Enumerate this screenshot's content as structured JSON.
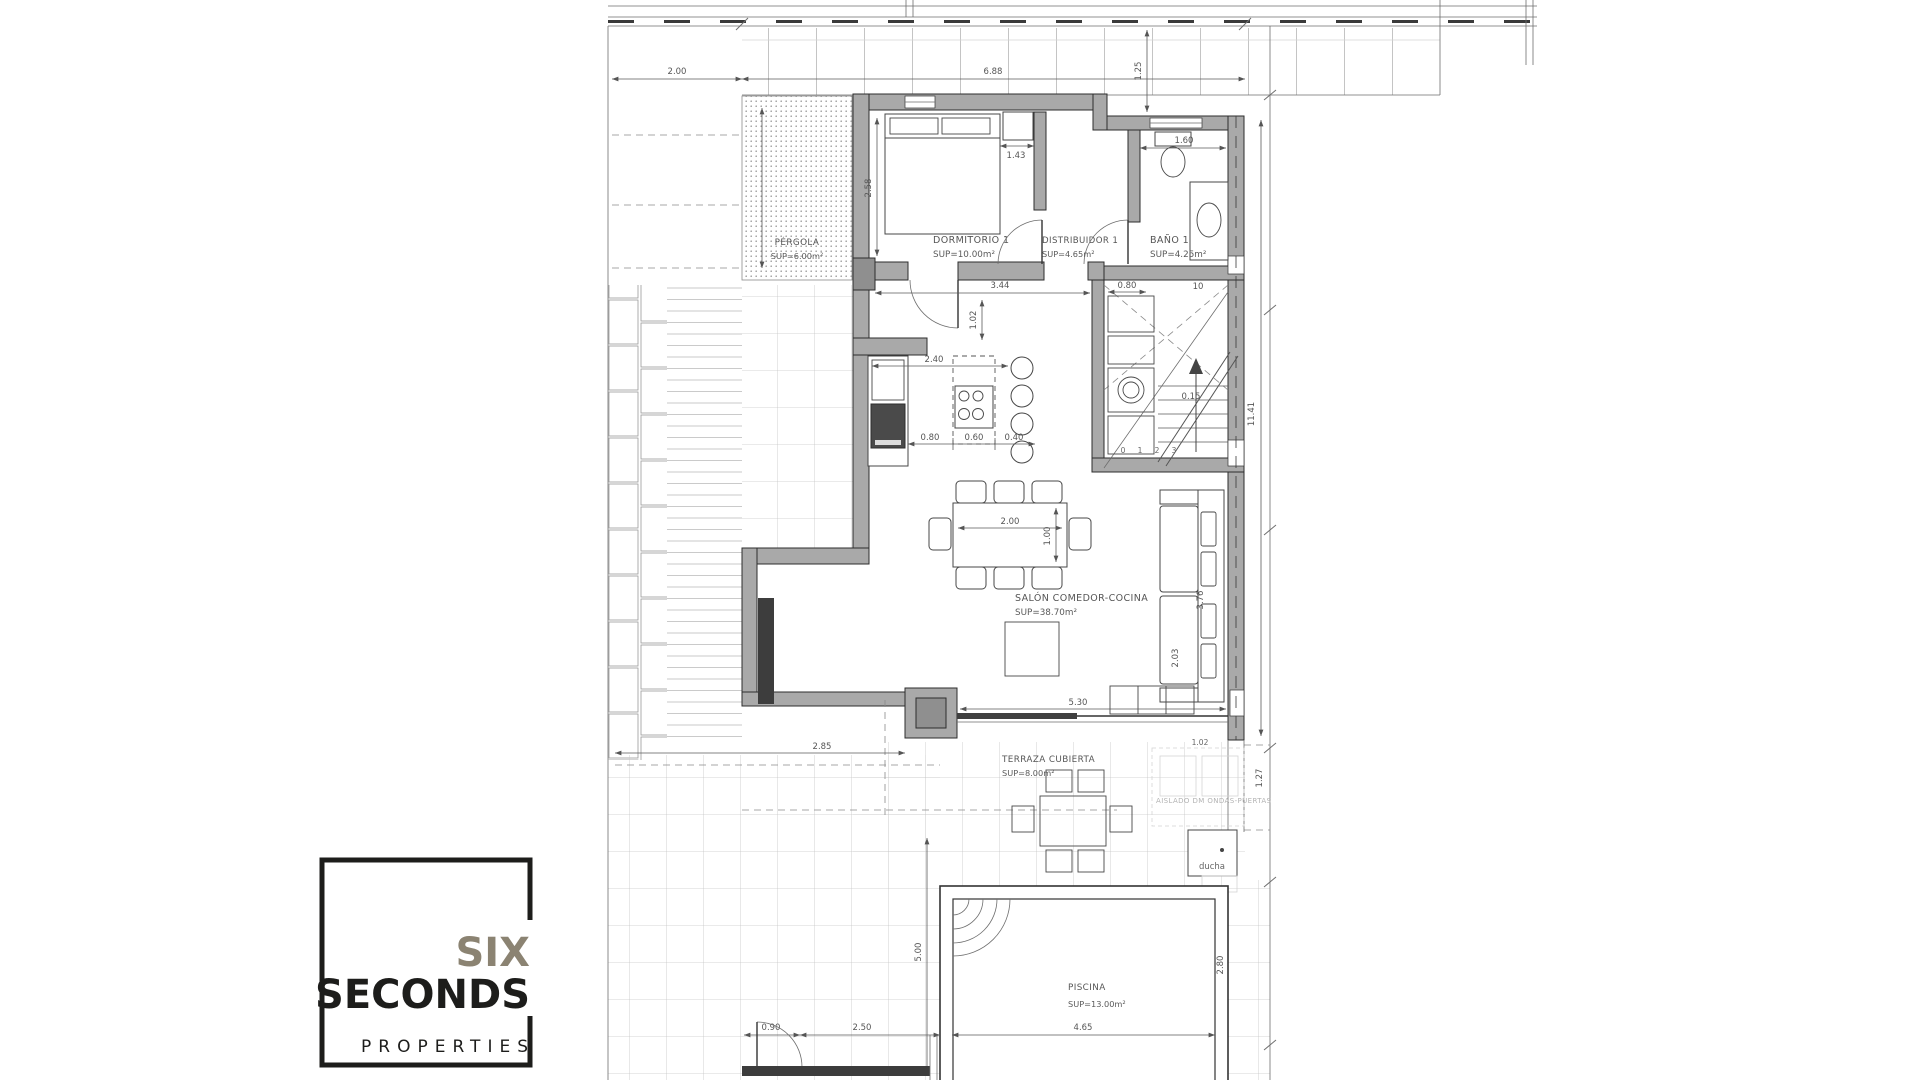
{
  "theme": {
    "wall-fill": "#a9a9a9",
    "dim": "#5a5a5a",
    "logo-dark": "#1d1d1b",
    "logo-accent": "#8b8372",
    "paper": "#ffffff"
  },
  "logo": {
    "word1": "SIX",
    "word2": "SECONDS",
    "word3": "PROPERTIES"
  },
  "rooms": {
    "pergola": {
      "name": "PÉRGOLA",
      "area": "SUP=6.00m²"
    },
    "dormitorio": {
      "name": "DORMITORIO 1",
      "area": "SUP=10.00m²"
    },
    "distribuidor": {
      "name": "DISTRIBUIDOR 1",
      "area": "SUP=4.65m²"
    },
    "bano": {
      "name": "BAÑO 1",
      "area": "SUP=4.25m²"
    },
    "salon": {
      "name": "SALÓN COMEDOR-COCINA",
      "area": "SUP=38.70m²"
    },
    "terraza": {
      "name": "TERRAZA CUBIERTA",
      "area": "SUP=8.00m²"
    },
    "piscina": {
      "name": "PISCINA",
      "area": "SUP=13.00m²"
    },
    "ducha": {
      "name": "ducha"
    }
  },
  "dims": {
    "plot_left": "2.00",
    "plot_top": "6.88",
    "top_gap": "1.25",
    "plot_right": "11.41",
    "bano_width": "1.60",
    "bed_width": "1.43",
    "bed_height": "2.58",
    "salon_top": "3.44",
    "hall_gap": "1.02",
    "kitchen_width": "2.40",
    "kitchen_a": "0.80",
    "kitchen_b": "0.60",
    "kitchen_c": "0.40",
    "stairs_width": "0.80",
    "stairs_steps": "10",
    "stairs_riser": "0.15",
    "step_numbers": [
      "0",
      "1",
      "2",
      "3"
    ],
    "table_width": "2.00",
    "table_depth": "1.00",
    "sofa_length": "3.76",
    "sofa_depth": "2.03",
    "salon_bottom": "5.30",
    "terraza_left": "2.85",
    "terraza_right": "1.02",
    "terraza_side": "1.27",
    "pool_offset": "5.00",
    "pool_height": "2.80",
    "gate": "0.90",
    "pool_left": "2.50",
    "pool_width": "4.65"
  },
  "annotations": {
    "watermark": "AISLADO DM ONDAS-PUERTAS"
  }
}
